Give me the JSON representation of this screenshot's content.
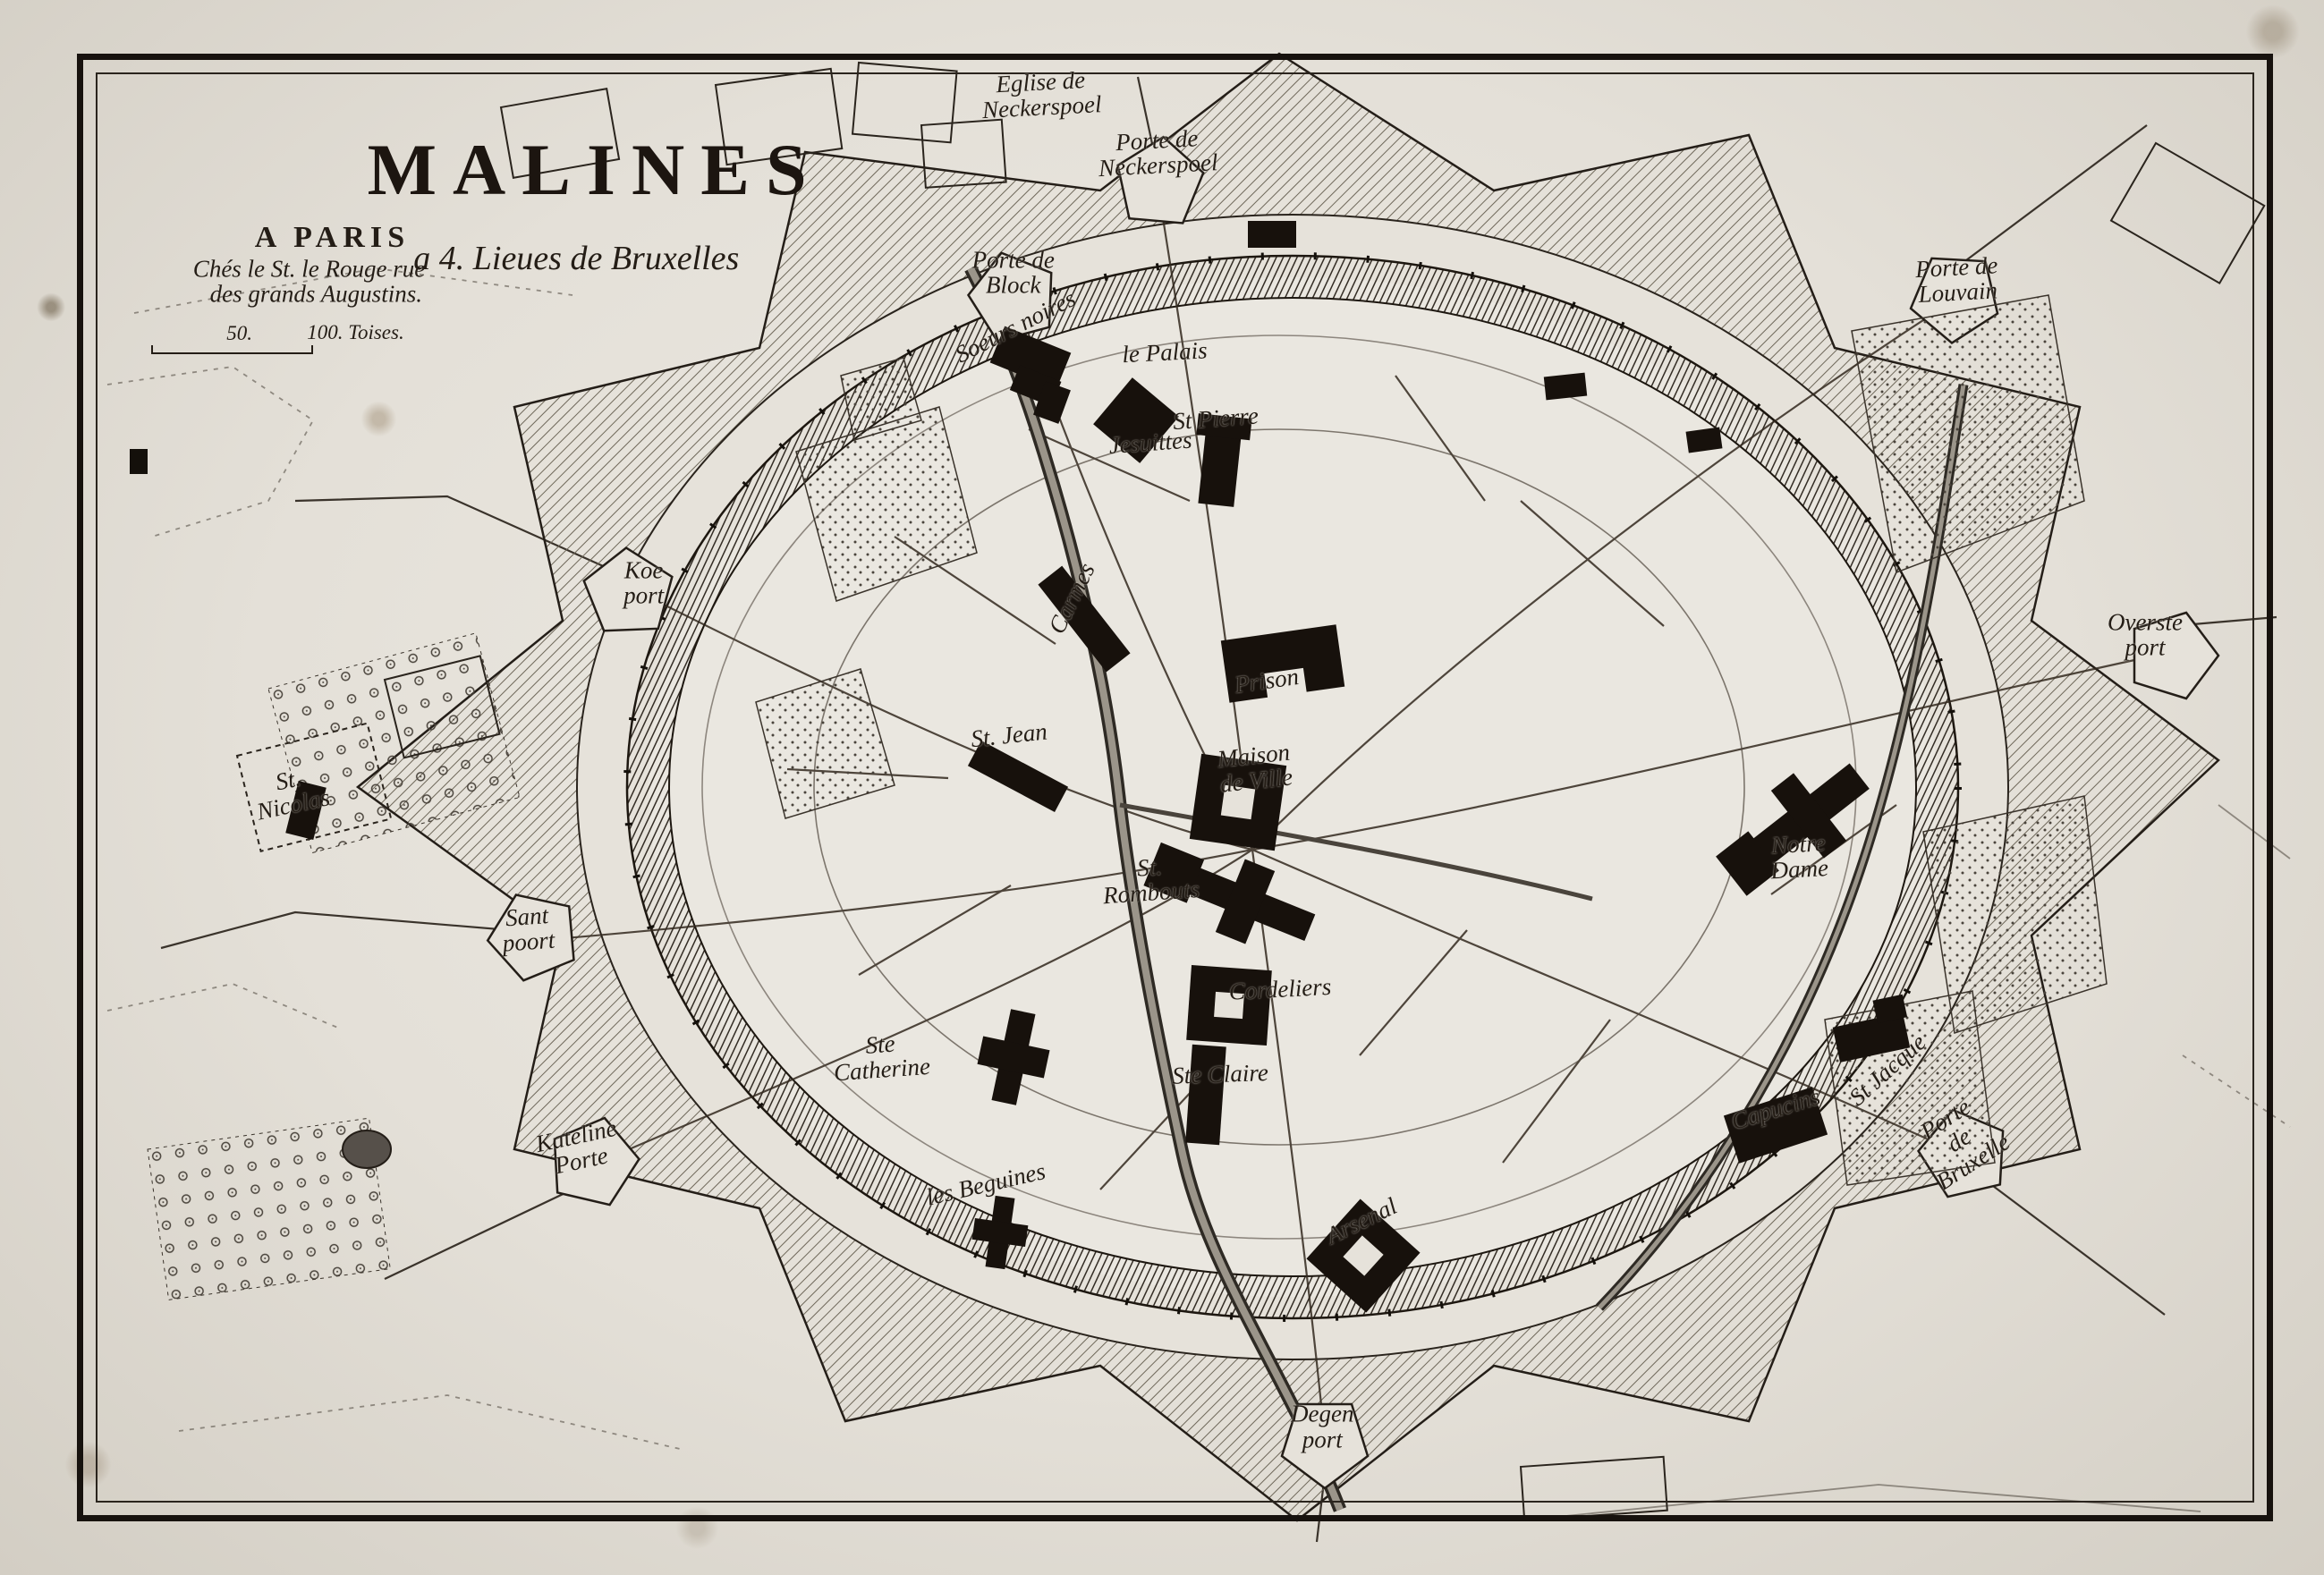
{
  "map": {
    "title": "MALINES",
    "subtitle": "a 4. Lieues de Bruxelles",
    "imprint": {
      "line1": "A PARIS",
      "line2": "Chés le St. le Rouge rue",
      "line3": "des grands Augustins."
    },
    "scale_bar": {
      "mid_label": "50.",
      "end_label": "100. Toises."
    },
    "colors": {
      "paper": "#e4e0d8",
      "ink": "#221b14",
      "wall_hatch": "#332c24"
    },
    "labels": [
      {
        "id": "eglise-de-neckerspoel",
        "text": "Eglise de\nNeckerspoel"
      },
      {
        "id": "porte-de-neckerspoel",
        "text": "Porte de\nNeckerspoel"
      },
      {
        "id": "porte-de-louvain",
        "text": "Porte de\nLouvain"
      },
      {
        "id": "porte-de-block",
        "text": "Porte de\nBlock"
      },
      {
        "id": "soeurs-noires",
        "text": "Soeurs noires"
      },
      {
        "id": "le-palais",
        "text": "le Palais"
      },
      {
        "id": "jesuittes",
        "text": "Jesuittes"
      },
      {
        "id": "st-pierre",
        "text": "St Pierre"
      },
      {
        "id": "koe-port",
        "text": "Koe\nport"
      },
      {
        "id": "carmes",
        "text": "Carmes"
      },
      {
        "id": "prison",
        "text": "Prison"
      },
      {
        "id": "st-jean",
        "text": "St. Jean"
      },
      {
        "id": "maison-de-ville",
        "text": "Maison\nde Ville"
      },
      {
        "id": "st-rombouts",
        "text": "St.\nRombouts"
      },
      {
        "id": "st-nicolas",
        "text": "St.\nNicolas"
      },
      {
        "id": "sant-poort",
        "text": "Sant\npoort"
      },
      {
        "id": "kateline-porte",
        "text": "Kateline\nPorte"
      },
      {
        "id": "ste-catherine",
        "text": "Ste\nCatherine"
      },
      {
        "id": "les-beguines",
        "text": "les Beguines"
      },
      {
        "id": "cordeliers",
        "text": "Cordeliers"
      },
      {
        "id": "ste-claire",
        "text": "Ste Claire"
      },
      {
        "id": "overste-port",
        "text": "Overste\nport"
      },
      {
        "id": "notre-dame",
        "text": "Notre\nDame"
      },
      {
        "id": "st-jacque",
        "text": "St Jacque"
      },
      {
        "id": "capucins",
        "text": "Capucins"
      },
      {
        "id": "porte-de-bruxelle",
        "text": "Porte\nde\nBruxelle"
      },
      {
        "id": "arsenal",
        "text": "Arsenal"
      },
      {
        "id": "degen-port",
        "text": "Degen\nport"
      }
    ]
  }
}
